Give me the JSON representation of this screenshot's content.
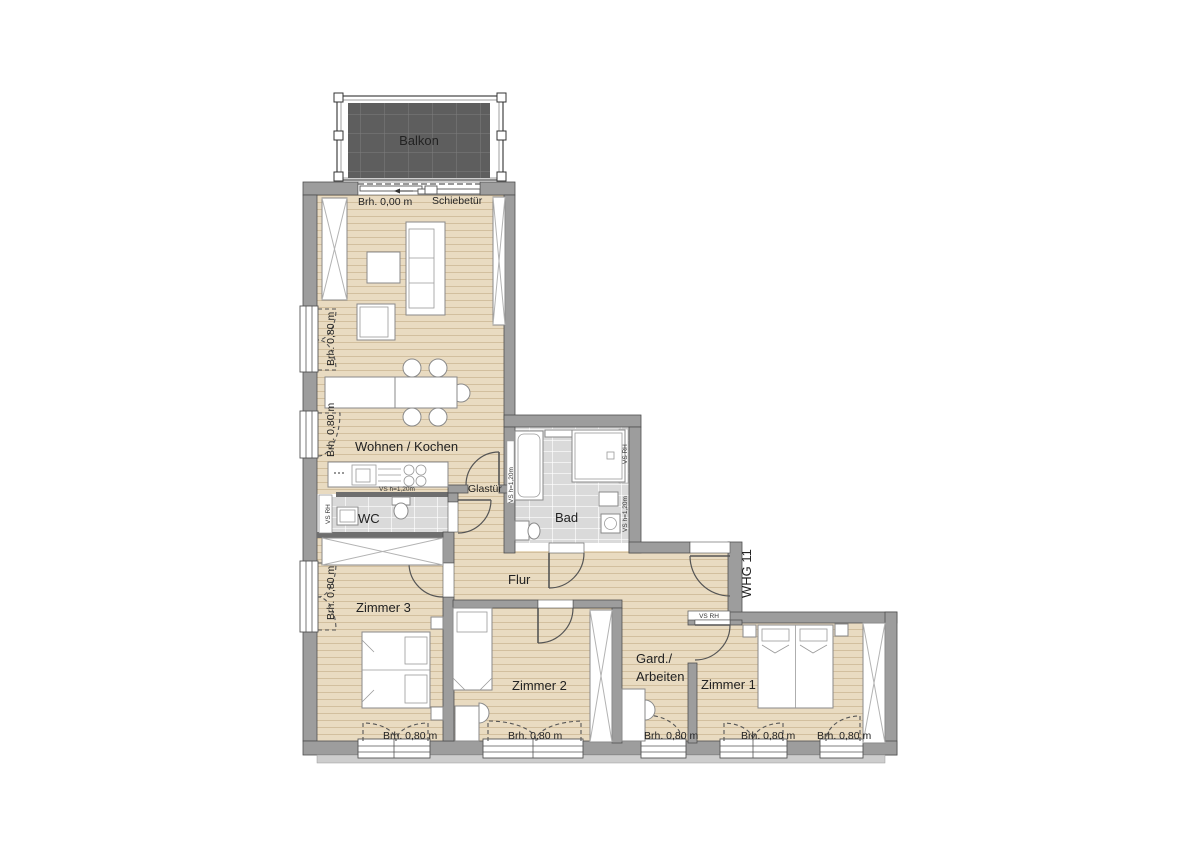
{
  "labels": {
    "balkon": "Balkon",
    "brh_000": "Brh. 0,00 m",
    "schiebetuer": "Schiebetür",
    "wohnen_kochen": "Wohnen / Kochen",
    "glastuer": "Glastür",
    "wc": "WC",
    "bad": "Bad",
    "flur": "Flur",
    "whg": "WHG 11",
    "zimmer1": "Zimmer 1",
    "zimmer2": "Zimmer 2",
    "zimmer3": "Zimmer 3",
    "gard_line1": "Gard./",
    "gard_line2": "Arbeiten",
    "brh_080": "Brh. 0,80 m",
    "vs_rh": "VS RH",
    "vs_h120": "VS h=1,20m"
  },
  "colors": {
    "wall": "#9d9d9d",
    "wall_edge": "#4f4f4f",
    "wood_floor": "#e9dbc1",
    "plank_line": "#d2bf9e",
    "tile": "#dadada",
    "balcony_deck": "#5e5e5e",
    "fixture": "#ffffff",
    "drawing_line": "#555555"
  }
}
